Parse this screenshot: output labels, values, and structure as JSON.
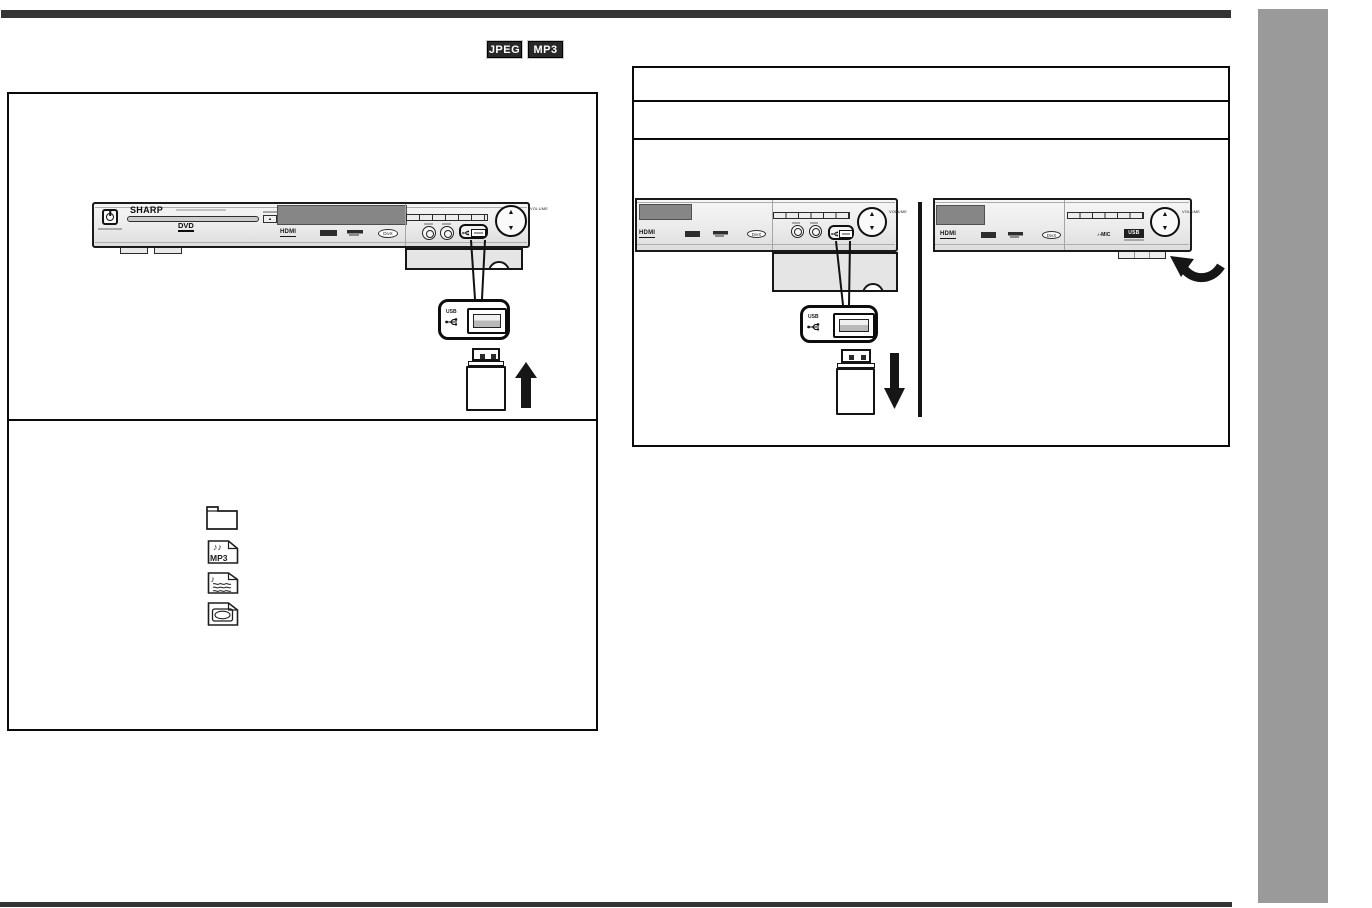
{
  "format_badges": {
    "jpeg": "JPEG",
    "mp3": "MP3"
  },
  "unit": {
    "brand": "SHARP",
    "dvd_logo": "DVD",
    "hdmi_logo": "HDMI",
    "divx_logo": "DivX",
    "volume_label": "VOLUME",
    "eject_glyph": "▲",
    "nav_up_glyph": "▲",
    "nav_down_glyph": "▼",
    "mic_label": "♪-MIC",
    "usb_badge_label": "USB"
  },
  "usb_callout": {
    "usb_label": "USB"
  },
  "file_icons": {
    "types": [
      "folder",
      "mp3-file",
      "audio-file",
      "image-file"
    ],
    "mp3_file_notes": "♪♪",
    "mp3_file_label": "MP3",
    "audio_file_note": "♪"
  },
  "colors": {
    "rule_bar": "#343434",
    "page_edge_tab": "#9a9a9a",
    "badge_bg": "#282828",
    "line_art": "#161616"
  }
}
